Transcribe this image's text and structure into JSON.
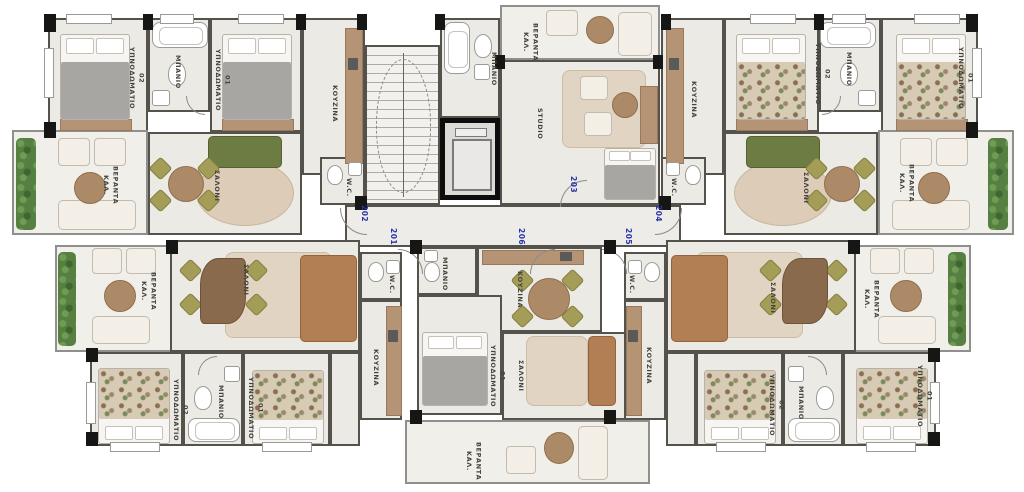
{
  "labels": {
    "bedroom": "ΥΠΝΟΔΩΜΑΤΙΟ",
    "num01": "01",
    "num02": "02",
    "bathroom": "ΜΠΑΝΙΟ",
    "kitchen": "ΚΟΥΖΙΝΑ",
    "living_room": "ΣΑΛΟΝΙ",
    "veranda_abbr": "ΚΑΛ.",
    "veranda": "ΒΕΡΑΝΤΑ",
    "studio": "STUDIO",
    "wc": "W.C."
  },
  "units": {
    "a201": "201",
    "a202": "202",
    "a203": "203",
    "a204": "204",
    "a205": "205",
    "a206": "206"
  },
  "colors": {
    "unit_number_blue": "#2834a8",
    "wall": "#55524c",
    "floor": "#eceae5",
    "sofa_green": "#6d7c42",
    "sofa_brown": "#b27e54",
    "olive_chair": "#a49d58",
    "wood": "#b59476",
    "plant_green": "#567f41"
  }
}
